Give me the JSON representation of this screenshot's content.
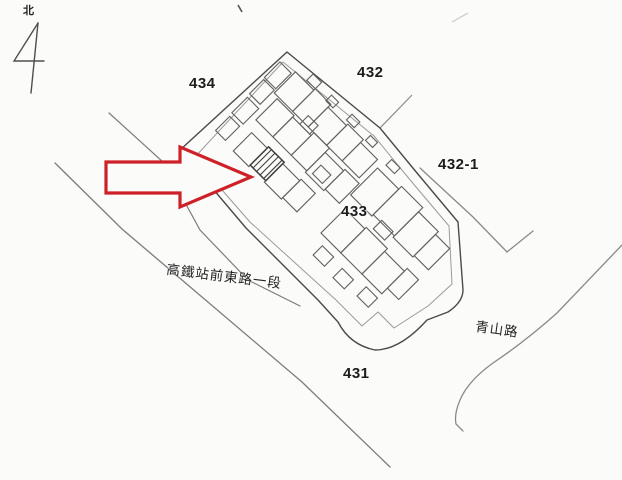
{
  "north": {
    "label": "北"
  },
  "parcels": [
    {
      "label": "434"
    },
    {
      "label": "432"
    },
    {
      "label": "432-1"
    },
    {
      "label": "433"
    },
    {
      "label": "431"
    }
  ],
  "roads": [
    {
      "label": "高鐵站前東路一段"
    },
    {
      "label": "青山路"
    }
  ],
  "annotation": {
    "arrow_color": "#cd2027"
  },
  "colors": {
    "ink": "#1c1c1c",
    "boundary": "#4a4a4a",
    "building_line": "#5f5f5f",
    "faint_line": "#8f8f8f",
    "paper": "#fbfbfa"
  }
}
